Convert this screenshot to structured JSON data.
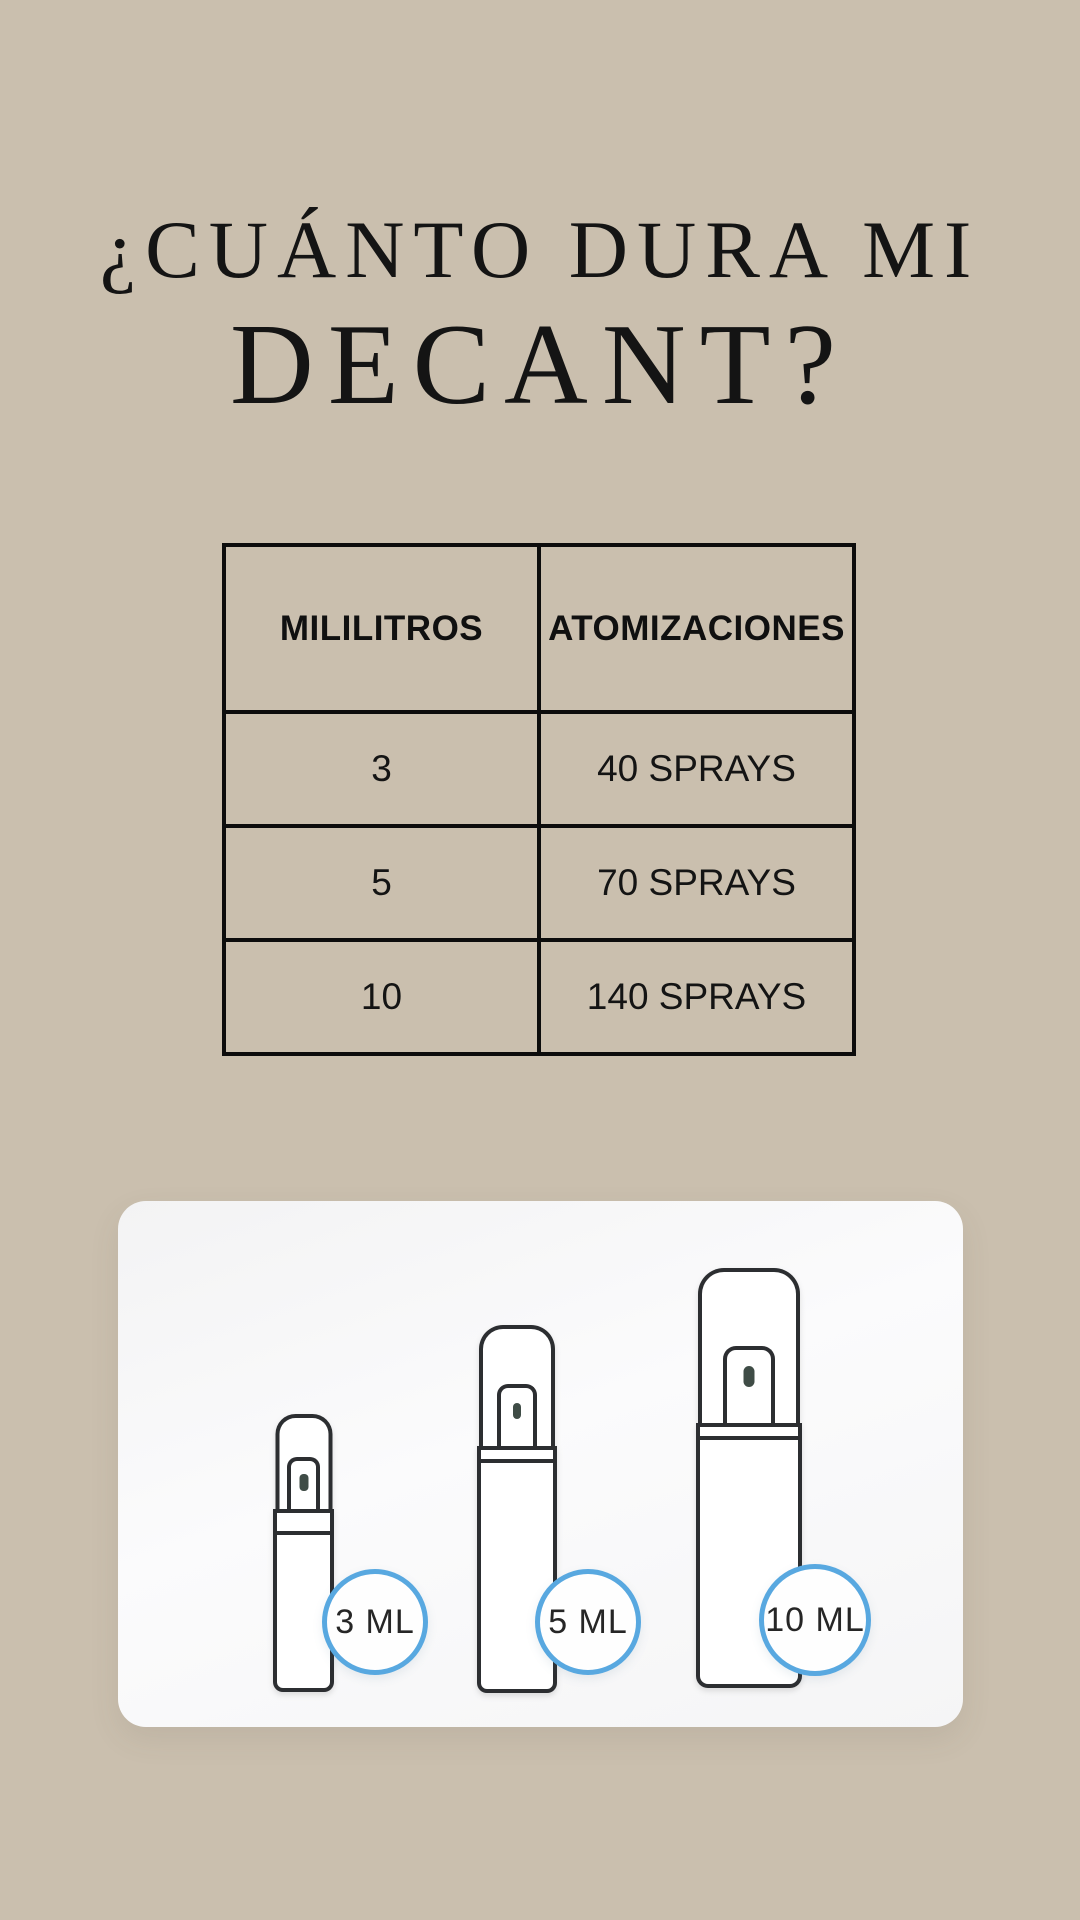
{
  "title": {
    "line1": "¿CUÁNTO DURA MI",
    "line2": "DECANT?"
  },
  "table": {
    "headers": [
      "MILILITROS",
      "ATOMIZACIONES"
    ],
    "rows": [
      [
        "3",
        "40 SPRAYS"
      ],
      [
        "5",
        "70 SPRAYS"
      ],
      [
        "10",
        "140 SPRAYS"
      ]
    ]
  },
  "bottles": [
    {
      "label": "3 ML"
    },
    {
      "label": "5 ML"
    },
    {
      "label": "10 ML"
    }
  ],
  "colors": {
    "background": "#cabfae",
    "text": "#141414",
    "table_border": "#0c0c0c",
    "card_background": "#f7f7f8",
    "bottle_outline": "#2c2e31",
    "badge_ring": "#58a8e0",
    "nozzle": "#3f4c46"
  },
  "chart_data": {
    "type": "table",
    "title": "¿Cuánto dura mi decant?",
    "categories": [
      "3 ML",
      "5 ML",
      "10 ML"
    ],
    "series": [
      {
        "name": "Atomizaciones (sprays)",
        "values": [
          40,
          70,
          140
        ]
      }
    ]
  }
}
